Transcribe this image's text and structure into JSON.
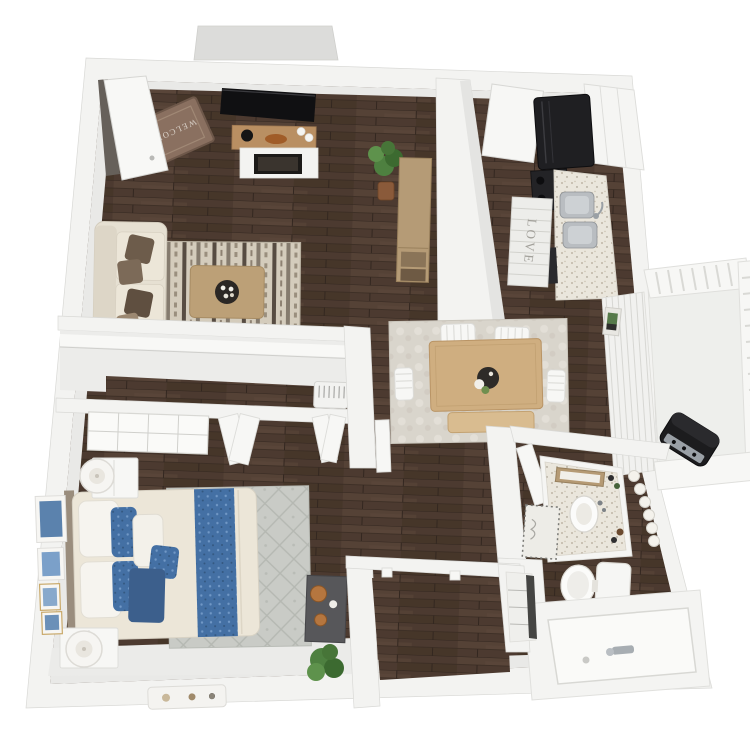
{
  "scene": {
    "type": "3d-floor-plan-render",
    "description": "Top-down 3D architectural rendering of a one-bedroom / one-bathroom apartment with balcony, dark wood floors and white walls",
    "background_color": "#ffffff"
  },
  "texts": {
    "welcome_mat": "WELCOME",
    "kitchen_runner": "LOVE"
  },
  "palette": {
    "wall_white": "#f3f3f1",
    "wall_stroke": "#d9d9d6",
    "wall_face": "#e9e9e7",
    "floor_wood": "#4c3a30",
    "floor_seam": "#332720",
    "sofa_cream": "#e6e0d2",
    "pillow_brown": "#6d5c4b",
    "rug_living": "#d4ccbc",
    "rug_dining": "#d9d5cc",
    "rug_bedroom": "#c9cbc6",
    "table_wood": "#cfae80",
    "console_wood": "#b59b76",
    "tv_black": "#101012",
    "appliance_black": "#1f1f22",
    "counter_speckle": "#eae6dc",
    "sink_steel": "#b9bdc1",
    "bed_cream": "#ece6d8",
    "accent_blue": "#4470a4",
    "accent_navy": "#3c5f8c",
    "plant_green": "#4e8040",
    "mat_brown": "#8a7060",
    "balcony_white": "#f0f1ee",
    "grill_black": "#1c1c1e"
  },
  "rooms": [
    {
      "name": "Entry",
      "furniture": [
        "open front door",
        "welcome mat"
      ]
    },
    {
      "name": "Living Room",
      "furniture": [
        "wall-mounted TV",
        "white fireplace media console",
        "floating wood shelf with decor",
        "cream sofa with brown throw pillows",
        "patterned kilim area rug",
        "wood coffee table with round serving tray",
        "potted plant",
        "bar console with storage crates"
      ]
    },
    {
      "name": "Kitchen",
      "furniture": [
        "black refrigerator",
        "black range",
        "black dishwasher",
        "double stainless sink",
        "speckled granite counter",
        "white upper cabinets",
        "striped runner rug",
        "white pantry door"
      ]
    },
    {
      "name": "Dining Area",
      "furniture": [
        "wood dining table",
        "two white head chairs",
        "two white side chairs",
        "wood bench",
        "mottled area rug",
        "round centerpiece tray"
      ]
    },
    {
      "name": "Balcony",
      "furniture": [
        "white slat railing",
        "barbecue grill",
        "sliding glass door with vertical blinds",
        "small wall art"
      ]
    },
    {
      "name": "Hallway",
      "furniture": [
        "long closet with shelf",
        "water-heater utility closet",
        "two pairs of open bi-fold doors",
        "mirrored sliding closet panel",
        "open hall door"
      ]
    },
    {
      "name": "Bedroom",
      "furniture": [
        "bed with cream duvet, white pillows, blue accent pillows and blue runner",
        "two white nightstands",
        "two round white table lamps",
        "gallery wall of blue artwork",
        "gray area rug",
        "charcoal accent console with wood bowls",
        "potted plant",
        "white floor tray"
      ]
    },
    {
      "name": "Bathroom",
      "furniture": [
        "vanity with speckled counter, vessel sink and marquee vanity lights",
        "framed sign above vanity",
        "toilet",
        "bathtub with chrome faucet",
        "dotted bath mat",
        "open door"
      ]
    },
    {
      "name": "Walk-in Closet",
      "furniture": [
        "door frames"
      ]
    },
    {
      "name": "Linen Closet",
      "furniture": [
        "shelves"
      ]
    }
  ]
}
